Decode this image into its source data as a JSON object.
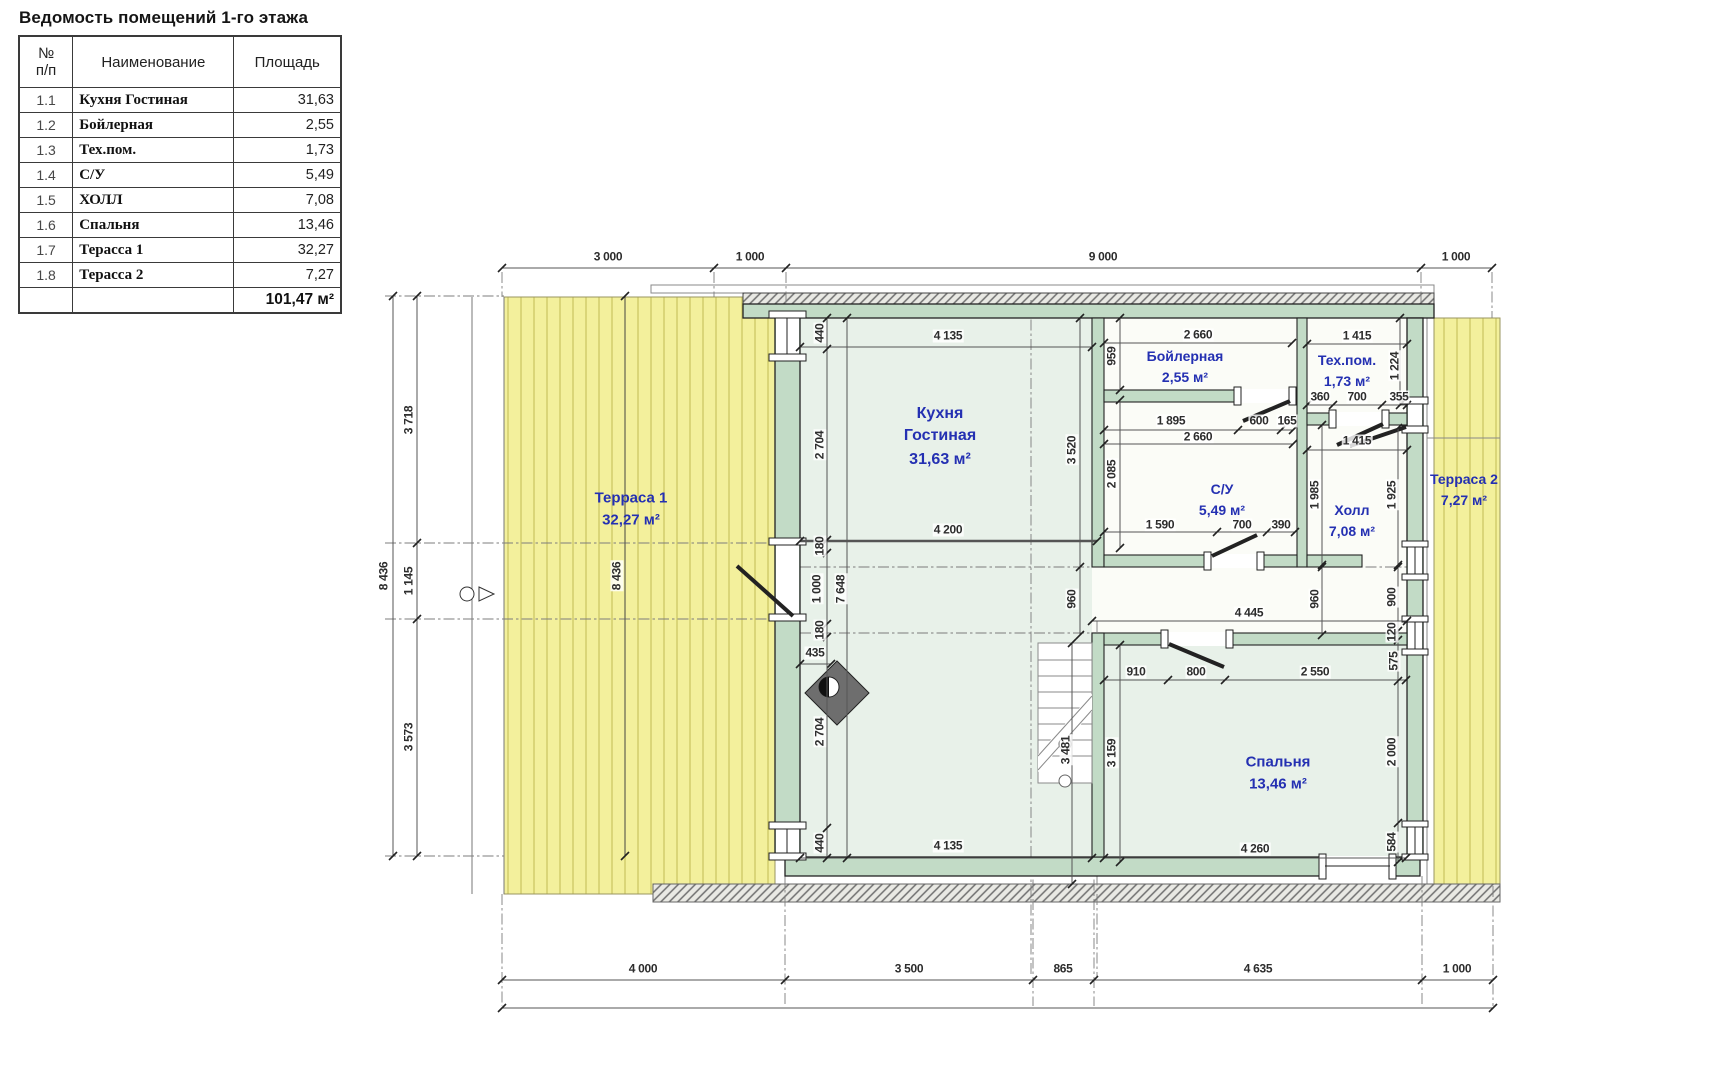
{
  "title": "Ведомость помещений 1-го этажа",
  "colors": {
    "room_label_blue": "#2430b2",
    "terrace_yellow": "#f3f09c",
    "floor_green": "#e8f1e9",
    "wall_green": "#c2dbc6"
  },
  "table": {
    "headers": {
      "num": "№\nп/п",
      "name": "Наименование",
      "area": "Площадь"
    },
    "rows": [
      {
        "num": "1.1",
        "name": "Кухня Гостиная",
        "area": "31,63"
      },
      {
        "num": "1.2",
        "name": "Бойлерная",
        "area": "2,55"
      },
      {
        "num": "1.3",
        "name": "Тех.пом.",
        "area": "1,73"
      },
      {
        "num": "1.4",
        "name": "С/У",
        "area": "5,49"
      },
      {
        "num": "1.5",
        "name": "ХОЛЛ",
        "area": "7,08"
      },
      {
        "num": "1.6",
        "name": "Спальня",
        "area": "13,46"
      },
      {
        "num": "1.7",
        "name": "Терасса 1",
        "area": "32,27"
      },
      {
        "num": "1.8",
        "name": "Терасса 2",
        "area": "7,27"
      }
    ],
    "total": "101,47 м²"
  },
  "plan": {
    "rooms": [
      {
        "name": "Кухня\nГостиная",
        "area": "31,63 м²",
        "x": 940,
        "y": 437,
        "fs": 16
      },
      {
        "name": "Бойлерная",
        "area": "2,55 м²",
        "x": 1185,
        "y": 367,
        "fs": 14
      },
      {
        "name": "Тех.пом.",
        "area": "1,73 м²",
        "x": 1347,
        "y": 371,
        "fs": 14
      },
      {
        "name": "С/У",
        "area": "5,49 м²",
        "x": 1222,
        "y": 500,
        "fs": 14
      },
      {
        "name": "Холл",
        "area": "7,08 м²",
        "x": 1352,
        "y": 521,
        "fs": 14
      },
      {
        "name": "Спальня",
        "area": "13,46 м²",
        "x": 1278,
        "y": 773,
        "fs": 15
      },
      {
        "name": "Терраса 1",
        "area": "32,27 м²",
        "x": 631,
        "y": 509,
        "fs": 15
      },
      {
        "name": "Терраса 2",
        "area": "7,27 м²",
        "x": 1464,
        "y": 490,
        "fs": 14
      }
    ],
    "dims": [
      {
        "t": "3 000",
        "x": 608,
        "y": 257,
        "r": 0
      },
      {
        "t": "1 000",
        "x": 750,
        "y": 257,
        "r": 0
      },
      {
        "t": "9 000",
        "x": 1103,
        "y": 257,
        "r": 0
      },
      {
        "t": "1 000",
        "x": 1456,
        "y": 257,
        "r": 0
      },
      {
        "t": "4 000",
        "x": 643,
        "y": 969,
        "r": 0
      },
      {
        "t": "3 500",
        "x": 909,
        "y": 969,
        "r": 0
      },
      {
        "t": "865",
        "x": 1063,
        "y": 969,
        "r": 0
      },
      {
        "t": "4 635",
        "x": 1258,
        "y": 969,
        "r": 0
      },
      {
        "t": "1 000",
        "x": 1457,
        "y": 969,
        "r": 0
      },
      {
        "t": "8 436",
        "x": 384,
        "y": 576,
        "r": 1
      },
      {
        "t": "3 718",
        "x": 409,
        "y": 420,
        "r": 1
      },
      {
        "t": "1 145",
        "x": 409,
        "y": 581,
        "r": 1
      },
      {
        "t": "3 573",
        "x": 409,
        "y": 737,
        "r": 1
      },
      {
        "t": "8 436",
        "x": 617,
        "y": 576,
        "r": 1
      },
      {
        "t": "4 135",
        "x": 948,
        "y": 336,
        "r": 0
      },
      {
        "t": "440",
        "x": 820,
        "y": 333,
        "r": 1
      },
      {
        "t": "2 704",
        "x": 820,
        "y": 445,
        "r": 1
      },
      {
        "t": "180",
        "x": 820,
        "y": 546,
        "r": 1
      },
      {
        "t": "1 000",
        "x": 817,
        "y": 589,
        "r": 1
      },
      {
        "t": "7 648",
        "x": 841,
        "y": 589,
        "r": 1
      },
      {
        "t": "180",
        "x": 820,
        "y": 630,
        "r": 1
      },
      {
        "t": "435",
        "x": 815,
        "y": 653,
        "r": 0
      },
      {
        "t": "2 704",
        "x": 820,
        "y": 732,
        "r": 1
      },
      {
        "t": "440",
        "x": 820,
        "y": 843,
        "r": 1
      },
      {
        "t": "4 135",
        "x": 948,
        "y": 846,
        "r": 0
      },
      {
        "t": "4 200",
        "x": 948,
        "y": 530,
        "r": 0
      },
      {
        "t": "2 660",
        "x": 1198,
        "y": 335,
        "r": 0
      },
      {
        "t": "959",
        "x": 1112,
        "y": 356,
        "r": 1
      },
      {
        "t": "1 895",
        "x": 1171,
        "y": 421,
        "r": 0
      },
      {
        "t": "600",
        "x": 1259,
        "y": 421,
        "r": 0
      },
      {
        "t": "165",
        "x": 1287,
        "y": 421,
        "r": 0
      },
      {
        "t": "2 660",
        "x": 1198,
        "y": 437,
        "r": 0
      },
      {
        "t": "2 085",
        "x": 1112,
        "y": 474,
        "r": 1
      },
      {
        "t": "3 520",
        "x": 1072,
        "y": 450,
        "r": 1
      },
      {
        "t": "1 590",
        "x": 1160,
        "y": 525,
        "r": 0
      },
      {
        "t": "700",
        "x": 1242,
        "y": 525,
        "r": 0
      },
      {
        "t": "390",
        "x": 1281,
        "y": 525,
        "r": 0
      },
      {
        "t": "1 415",
        "x": 1357,
        "y": 336,
        "r": 0
      },
      {
        "t": "1 224",
        "x": 1395,
        "y": 366,
        "r": 1
      },
      {
        "t": "360",
        "x": 1320,
        "y": 397,
        "r": 0
      },
      {
        "t": "700",
        "x": 1357,
        "y": 397,
        "r": 0
      },
      {
        "t": "355",
        "x": 1399,
        "y": 397,
        "r": 0
      },
      {
        "t": "1 415",
        "x": 1357,
        "y": 441,
        "r": 0
      },
      {
        "t": "1 985",
        "x": 1315,
        "y": 495,
        "r": 1
      },
      {
        "t": "1 925",
        "x": 1392,
        "y": 495,
        "r": 1
      },
      {
        "t": "960",
        "x": 1072,
        "y": 599,
        "r": 1
      },
      {
        "t": "960",
        "x": 1315,
        "y": 599,
        "r": 1
      },
      {
        "t": "900",
        "x": 1392,
        "y": 597,
        "r": 1
      },
      {
        "t": "120",
        "x": 1392,
        "y": 632,
        "r": 1
      },
      {
        "t": "4 445",
        "x": 1249,
        "y": 613,
        "r": 0
      },
      {
        "t": "3 481",
        "x": 1066,
        "y": 750,
        "r": 1
      },
      {
        "t": "575",
        "x": 1394,
        "y": 661,
        "r": 1
      },
      {
        "t": "910",
        "x": 1136,
        "y": 672,
        "r": 0
      },
      {
        "t": "800",
        "x": 1196,
        "y": 672,
        "r": 0
      },
      {
        "t": "2 550",
        "x": 1315,
        "y": 672,
        "r": 0
      },
      {
        "t": "3 159",
        "x": 1112,
        "y": 753,
        "r": 1
      },
      {
        "t": "2 000",
        "x": 1392,
        "y": 752,
        "r": 1
      },
      {
        "t": "584",
        "x": 1392,
        "y": 842,
        "r": 1
      },
      {
        "t": "4 260",
        "x": 1255,
        "y": 849,
        "r": 0
      }
    ]
  }
}
